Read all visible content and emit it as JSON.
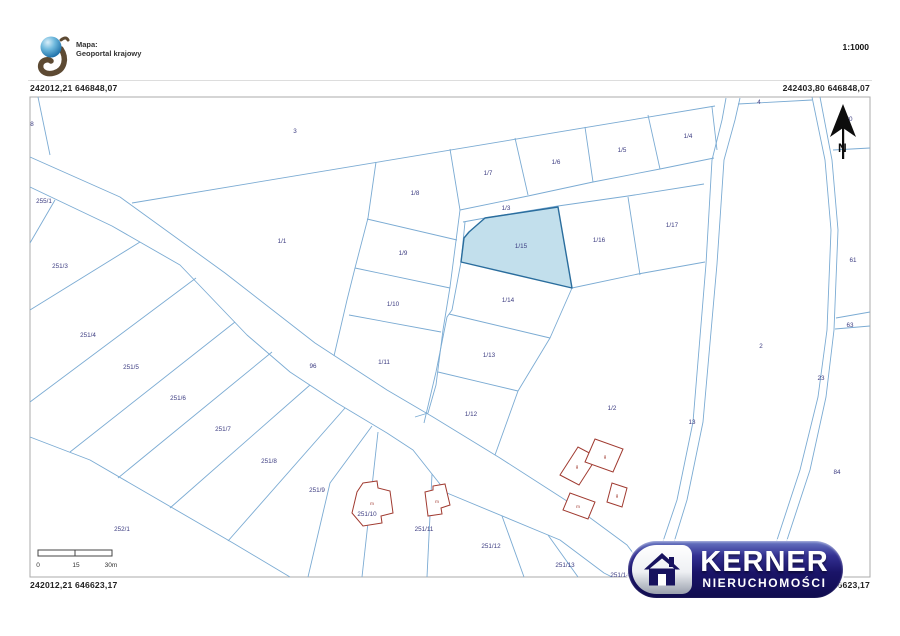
{
  "header": {
    "map_source_label": "Mapa:",
    "map_source_name": "Geoportal krajowy",
    "scale_ratio": "1:1000"
  },
  "coordinates": {
    "top_left": "242012,21 646848,07",
    "top_right": "242403,80 646848,07",
    "bottom_left": "242012,21 646623,17",
    "bottom_right": "242403,80 646623,17"
  },
  "north_arrow_label": "N",
  "scale_bar": {
    "tick_labels": [
      "0",
      "15",
      "30m"
    ]
  },
  "watermark": {
    "name": "KERNER",
    "subtitle": "NIERUCHOMOŚCI"
  },
  "colors": {
    "parcel_line": "#7babd3",
    "frame": "#ababab",
    "label": "#3b3b80",
    "highlight_fill": "#badbe9",
    "highlight_stroke": "#2a6d9d",
    "building": "#a03a30",
    "logo_navy": "#17125e"
  },
  "map": {
    "highlight_parcel": {
      "id": "1/15",
      "points": "485,218 558,207 572,288 461,262 464,238 469,232"
    },
    "lines": [
      {
        "name": "road-96-upper",
        "points": "30,157 120,197 225,273 315,343 387,390 433,417 500,458 570,503 627,545 639,561"
      },
      {
        "name": "road-96-lower",
        "points": "30,187 112,226 180,265 247,335 290,372 337,403 387,433 413,450 447,493 560,540 604,573 612,577"
      },
      {
        "name": "boundary-parcel-3",
        "points": "132,203 715,106"
      },
      {
        "name": "parcel-8-line",
        "points": "38,97 50,155"
      },
      {
        "name": "column-left-boundary",
        "points": "376,162 368,218 355,268 347,300 334,356"
      },
      {
        "name": "div-1-8-1-9",
        "points": "367,219 457,240"
      },
      {
        "name": "div-1-9-1-10",
        "points": "355,268 450,288"
      },
      {
        "name": "div-1-10-1-11",
        "points": "349,315 441,332"
      },
      {
        "name": "narrow-road-left",
        "points": "460,210 450,287 443,330 436,385 428,413 415,417"
      },
      {
        "name": "narrow-road-right",
        "points": "465,222 461,262 452,310 447,317 436,372 424,423"
      },
      {
        "name": "div-1-8-1-7",
        "points": "450,149 460,210"
      },
      {
        "name": "div-1-7-1-6",
        "points": "515,138 528,195"
      },
      {
        "name": "div-1-6-1-5",
        "points": "585,127 593,182"
      },
      {
        "name": "div-1-5-1-4",
        "points": "648,115 660,169"
      },
      {
        "name": "parcel-1-4-right",
        "points": "712,107 717,150"
      },
      {
        "name": "road-1-3-upper",
        "points": "460,210 528,196 593,182 660,169 714,158"
      },
      {
        "name": "road-1-3-lower",
        "points": "463,222 485,218 558,206 628,196 704,184"
      },
      {
        "name": "div-1-16-1-17",
        "points": "628,197 640,275"
      },
      {
        "name": "bottom-1-16-1-17",
        "points": "572,288 638,274 705,262"
      },
      {
        "name": "column2-right-boundary",
        "points": "572,288 550,338 518,391 495,455"
      },
      {
        "name": "div-1-14-1-13",
        "points": "449,314 550,338"
      },
      {
        "name": "div-1-13-1-12",
        "points": "438,372 518,391"
      },
      {
        "name": "road-13-left",
        "points": "726,98 722,120 712,160 706,264 693,422 677,500 655,565 651,577"
      },
      {
        "name": "road-13-right",
        "points": "740,98 735,120 724,160 717,264 703,422 687,500 667,565 662,577"
      },
      {
        "name": "road-4-line",
        "points": "738,104 812,100"
      },
      {
        "name": "road-23-left",
        "points": "812,97 825,160 831,230 827,330 818,397 800,470 777,540 764,577"
      },
      {
        "name": "road-23-right",
        "points": "820,97 832,160 838,230 834,330 826,397 810,470 787,540 775,577"
      },
      {
        "name": "boundary-61-top",
        "points": "833,150 870,148"
      },
      {
        "name": "strip-63-upper",
        "points": "836,318 870,312"
      },
      {
        "name": "strip-63-lower",
        "points": "835,329 870,326"
      },
      {
        "name": "div-255-1-251-3",
        "points": "30,243 55,200"
      },
      {
        "name": "div-251-3-251-4",
        "points": "30,310 140,242"
      },
      {
        "name": "div-251-4-251-5",
        "points": "30,402 196,278"
      },
      {
        "name": "div-251-5-251-6",
        "points": "70,452 235,322"
      },
      {
        "name": "div-251-6-251-7",
        "points": "118,478 272,352"
      },
      {
        "name": "div-251-7-251-8",
        "points": "170,508 310,385"
      },
      {
        "name": "div-251-8-251-9",
        "points": "228,541 345,408"
      },
      {
        "name": "boundary-252-1",
        "points": "30,437 90,460 233,543 290,577"
      },
      {
        "name": "div-251-9-251-10",
        "points": "372,426 330,483 308,577"
      },
      {
        "name": "div-251-10-251-11",
        "points": "378,432 362,577"
      },
      {
        "name": "div-251-11-251-12",
        "points": "432,474 427,577"
      },
      {
        "name": "div-251-12-251-13",
        "points": "502,516 524,577"
      },
      {
        "name": "div-251-13-251-14",
        "points": "548,535 578,577"
      }
    ],
    "labels": [
      {
        "text": "8",
        "x": 32,
        "y": 124
      },
      {
        "text": "3",
        "x": 295,
        "y": 131
      },
      {
        "text": "255/1",
        "x": 44,
        "y": 201
      },
      {
        "text": "1/1",
        "x": 282,
        "y": 241
      },
      {
        "text": "251/3",
        "x": 60,
        "y": 266
      },
      {
        "text": "251/4",
        "x": 88,
        "y": 335
      },
      {
        "text": "251/5",
        "x": 131,
        "y": 367
      },
      {
        "text": "251/6",
        "x": 178,
        "y": 398
      },
      {
        "text": "251/7",
        "x": 223,
        "y": 429
      },
      {
        "text": "251/8",
        "x": 269,
        "y": 461
      },
      {
        "text": "251/9",
        "x": 317,
        "y": 490
      },
      {
        "text": "252/1",
        "x": 122,
        "y": 529
      },
      {
        "text": "96",
        "x": 313,
        "y": 366
      },
      {
        "text": "1/8",
        "x": 415,
        "y": 193
      },
      {
        "text": "1/7",
        "x": 488,
        "y": 173
      },
      {
        "text": "1/6",
        "x": 556,
        "y": 162
      },
      {
        "text": "1/5",
        "x": 622,
        "y": 150
      },
      {
        "text": "1/4",
        "x": 688,
        "y": 136
      },
      {
        "text": "1/3",
        "x": 506,
        "y": 208
      },
      {
        "text": "4",
        "x": 759,
        "y": 102
      },
      {
        "text": "80",
        "x": 849,
        "y": 119
      },
      {
        "text": "1/15",
        "x": 521,
        "y": 246
      },
      {
        "text": "1/16",
        "x": 599,
        "y": 240
      },
      {
        "text": "1/17",
        "x": 672,
        "y": 225
      },
      {
        "text": "1/9",
        "x": 403,
        "y": 253
      },
      {
        "text": "1/10",
        "x": 393,
        "y": 304
      },
      {
        "text": "1/11",
        "x": 384,
        "y": 362
      },
      {
        "text": "1/14",
        "x": 508,
        "y": 300
      },
      {
        "text": "1/13",
        "x": 489,
        "y": 355
      },
      {
        "text": "1/12",
        "x": 471,
        "y": 414
      },
      {
        "text": "1/2",
        "x": 612,
        "y": 408
      },
      {
        "text": "13",
        "x": 692,
        "y": 422
      },
      {
        "text": "2",
        "x": 761,
        "y": 346
      },
      {
        "text": "23",
        "x": 821,
        "y": 378
      },
      {
        "text": "61",
        "x": 853,
        "y": 260
      },
      {
        "text": "63",
        "x": 850,
        "y": 325
      },
      {
        "text": "84",
        "x": 837,
        "y": 472
      },
      {
        "text": "251/10",
        "x": 367,
        "y": 514
      },
      {
        "text": "251/11",
        "x": 424,
        "y": 529
      },
      {
        "text": "251/12",
        "x": 491,
        "y": 546
      },
      {
        "text": "251/13",
        "x": 565,
        "y": 565
      },
      {
        "text": "251/14",
        "x": 620,
        "y": 575
      }
    ],
    "buildings": [
      {
        "label": "g",
        "lx": 577,
        "ly": 466,
        "points": "560,475 578,447 597,457 579,485"
      },
      {
        "label": "g",
        "lx": 605,
        "ly": 456,
        "points": "595,439 623,449 613,472 585,462"
      },
      {
        "label": "m",
        "lx": 578,
        "ly": 506,
        "points": "563,510 570,493 595,502 588,519"
      },
      {
        "label": "g",
        "lx": 617,
        "ly": 495,
        "points": "607,502 612,483 627,488 622,507"
      },
      {
        "label": "m",
        "lx": 372,
        "ly": 503,
        "points": "363,483 377,481 378,488 390,491 393,513 381,516 382,523 363,526 352,513 357,492"
      },
      {
        "label": "m",
        "lx": 437,
        "ly": 501,
        "points": "425,492 433,490 433,486 445,484 450,505 441,508 442,514 428,516"
      }
    ]
  }
}
